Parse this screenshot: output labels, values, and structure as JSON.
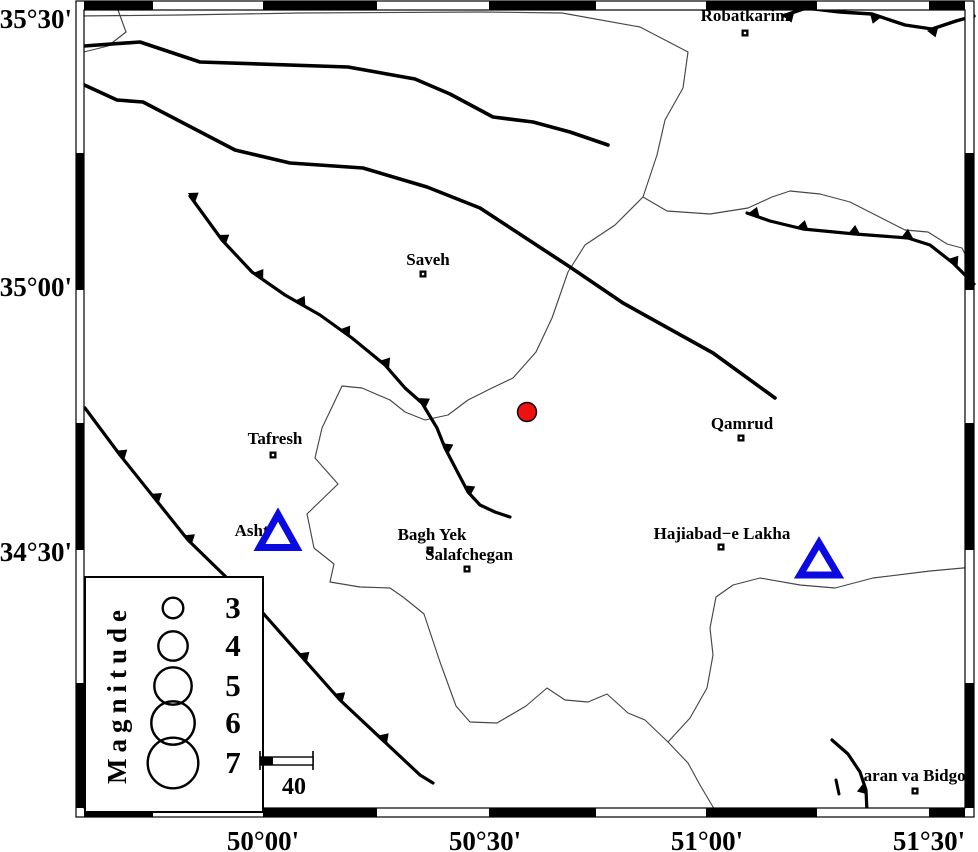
{
  "figure": {
    "kind": "seismicity-map",
    "width": 978,
    "height": 852
  },
  "colors": {
    "background": "#ffffff",
    "frame": "#000000",
    "fault": "#000000",
    "river": "#474747",
    "epicenter_fill": "#ee1111",
    "epicenter_stroke": "#000000",
    "station_stroke": "#0b0be1",
    "text": "#000000"
  },
  "axis": {
    "left_labels": [
      {
        "text": "35°30'",
        "x": 72,
        "y": 28
      },
      {
        "text": "35°00'",
        "x": 72,
        "y": 296
      },
      {
        "text": "34°30'",
        "x": 72,
        "y": 561
      }
    ],
    "bottom_labels": [
      {
        "text": "50°00'",
        "x": 263,
        "y": 850
      },
      {
        "text": "50°30'",
        "x": 485,
        "y": 850
      },
      {
        "text": "51°00'",
        "x": 707,
        "y": 850
      },
      {
        "text": "51°30'",
        "x": 929,
        "y": 850
      }
    ]
  },
  "frame": {
    "outer": [
      76,
      1,
      974,
      817
    ],
    "inner": [
      84,
      10,
      965,
      808
    ],
    "h_bounds": [
      84,
      153,
      263,
      377,
      489,
      596,
      706,
      817,
      929,
      965
    ],
    "h_first_black": true,
    "v_bounds": [
      10,
      153,
      290,
      423,
      550,
      683,
      808
    ],
    "v_first_black": false
  },
  "cities": [
    {
      "name": "Robatkarim",
      "label_x": 745,
      "label_y": 21,
      "x": 745,
      "y": 33
    },
    {
      "name": "Saveh",
      "label_x": 428,
      "label_y": 265,
      "x": 423,
      "y": 274
    },
    {
      "name": "Tafresh",
      "label_x": 275,
      "label_y": 444,
      "x": 273,
      "y": 455
    },
    {
      "name": "Ashtian",
      "label_x": 263,
      "label_y": 536,
      "x": 266,
      "y": 544
    },
    {
      "name": "Bagh Yek",
      "label_x": 432,
      "label_y": 540,
      "x": 430,
      "y": 550
    },
    {
      "name": "Salafchegan",
      "label_x": 469,
      "label_y": 560,
      "x": 467,
      "y": 569
    },
    {
      "name": "Qamrud",
      "label_x": 742,
      "label_y": 429,
      "x": 741,
      "y": 438
    },
    {
      "name": "Hajiabad−e Lakha",
      "label_x": 722,
      "label_y": 539,
      "x": 721,
      "y": 547
    },
    {
      "name": "aran va Bidgol",
      "label_x": 917,
      "label_y": 781,
      "x": 915,
      "y": 791
    }
  ],
  "epicenter": {
    "x": 527,
    "y": 412,
    "r": 9.5
  },
  "stations": [
    {
      "x": 278,
      "y": 531,
      "w": 37,
      "h": 33
    },
    {
      "x": 819,
      "y": 559,
      "w": 38,
      "h": 32
    }
  ],
  "faults": [
    {
      "id": "f1",
      "width": 3.6,
      "points": [
        [
          84,
          46
        ],
        [
          140,
          42
        ],
        [
          200,
          62
        ],
        [
          348,
          67
        ],
        [
          415,
          79
        ],
        [
          450,
          94
        ],
        [
          493,
          117
        ],
        [
          533,
          122
        ],
        [
          570,
          132
        ],
        [
          608,
          145
        ]
      ],
      "teeth": null
    },
    {
      "id": "f2",
      "width": 3.6,
      "points": [
        [
          80,
          83
        ],
        [
          117,
          100
        ],
        [
          143,
          102
        ],
        [
          235,
          150
        ],
        [
          290,
          163
        ],
        [
          363,
          168
        ],
        [
          427,
          187
        ],
        [
          480,
          208
        ],
        [
          570,
          267
        ],
        [
          623,
          303
        ],
        [
          713,
          353
        ],
        [
          775,
          398
        ]
      ],
      "teeth": null
    },
    {
      "id": "f3",
      "width": 3.2,
      "points": [
        [
          190,
          196
        ],
        [
          222,
          240
        ],
        [
          252,
          272
        ],
        [
          285,
          295
        ],
        [
          320,
          315
        ],
        [
          352,
          338
        ],
        [
          385,
          365
        ],
        [
          405,
          388
        ],
        [
          422,
          403
        ],
        [
          437,
          428
        ],
        [
          445,
          448
        ],
        [
          458,
          473
        ],
        [
          468,
          492
        ],
        [
          480,
          505
        ],
        [
          495,
          512
        ],
        [
          510,
          517
        ]
      ],
      "teeth": {
        "side": 1,
        "t": [
          0.005,
          0.117,
          0.228,
          0.336,
          0.451,
          0.56,
          0.677,
          0.787,
          0.889
        ]
      }
    },
    {
      "id": "f4",
      "width": 3.2,
      "points": [
        [
          747,
          213
        ],
        [
          770,
          221
        ],
        [
          803,
          229
        ],
        [
          855,
          234
        ],
        [
          908,
          238
        ],
        [
          930,
          245
        ],
        [
          953,
          263
        ],
        [
          974,
          284
        ]
      ],
      "teeth": {
        "side": 1,
        "t": [
          0.03,
          0.236,
          0.447,
          0.663,
          0.878
        ]
      }
    },
    {
      "id": "f5",
      "width": 3.2,
      "points": [
        [
          85,
          408
        ],
        [
          120,
          455
        ],
        [
          188,
          540
        ],
        [
          262,
          612
        ],
        [
          340,
          700
        ],
        [
          420,
          775
        ],
        [
          433,
          783
        ]
      ],
      "teeth": {
        "side": 1,
        "t": [
          0.115,
          0.223,
          0.326,
          0.647,
          0.752,
          0.87
        ]
      }
    },
    {
      "id": "f6",
      "width": 3.4,
      "points": [
        [
          783,
          16
        ],
        [
          806,
          8
        ],
        [
          840,
          12
        ],
        [
          872,
          14
        ],
        [
          905,
          25
        ],
        [
          932,
          29
        ],
        [
          956,
          21
        ],
        [
          974,
          16
        ]
      ],
      "teeth": {
        "side": -1,
        "t": [
          0.03,
          0.48,
          0.78
        ]
      }
    },
    {
      "id": "f7",
      "width": 3.2,
      "points": [
        [
          832,
          740
        ],
        [
          848,
          754
        ],
        [
          860,
          772
        ],
        [
          866,
          790
        ],
        [
          867,
          812
        ]
      ],
      "teeth": {
        "side": -1,
        "t": [
          0.72
        ]
      }
    },
    {
      "id": "f8",
      "width": 3.0,
      "points": [
        [
          836,
          780
        ],
        [
          839,
          794
        ]
      ],
      "teeth": null
    }
  ],
  "rivers": [
    {
      "id": "r-top",
      "points": [
        [
          77,
          16
        ],
        [
          180,
          15
        ],
        [
          300,
          13
        ],
        [
          480,
          12
        ],
        [
          562,
          13
        ],
        [
          640,
          27
        ],
        [
          688,
          52
        ],
        [
          683,
          88
        ],
        [
          665,
          120
        ],
        [
          657,
          155
        ],
        [
          643,
          197
        ]
      ]
    },
    {
      "id": "r-top-stub",
      "points": [
        [
          118,
          10
        ],
        [
          126,
          32
        ],
        [
          108,
          46
        ],
        [
          84,
          52
        ]
      ]
    },
    {
      "id": "r-east",
      "points": [
        [
          643,
          197
        ],
        [
          667,
          211
        ],
        [
          710,
          214
        ],
        [
          748,
          208
        ],
        [
          772,
          197
        ],
        [
          790,
          191
        ],
        [
          820,
          194
        ],
        [
          850,
          202
        ],
        [
          905,
          230
        ],
        [
          928,
          232
        ],
        [
          947,
          244
        ],
        [
          962,
          248
        ],
        [
          970,
          264
        ],
        [
          974,
          292
        ]
      ]
    },
    {
      "id": "r-boundary",
      "points": [
        [
          643,
          197
        ],
        [
          615,
          225
        ],
        [
          585,
          245
        ],
        [
          568,
          272
        ],
        [
          552,
          318
        ],
        [
          536,
          352
        ],
        [
          513,
          378
        ],
        [
          492,
          388
        ],
        [
          468,
          400
        ],
        [
          448,
          415
        ],
        [
          425,
          420
        ],
        [
          405,
          412
        ],
        [
          390,
          400
        ],
        [
          362,
          388
        ],
        [
          342,
          386
        ],
        [
          322,
          428
        ],
        [
          315,
          458
        ],
        [
          338,
          484
        ],
        [
          307,
          514
        ],
        [
          314,
          548
        ],
        [
          334,
          564
        ],
        [
          330,
          582
        ],
        [
          360,
          587
        ],
        [
          390,
          588
        ],
        [
          403,
          597
        ],
        [
          413,
          605
        ],
        [
          424,
          614
        ],
        [
          440,
          662
        ],
        [
          456,
          706
        ],
        [
          470,
          722
        ],
        [
          497,
          723
        ],
        [
          526,
          706
        ],
        [
          547,
          688
        ],
        [
          565,
          700
        ],
        [
          588,
          702
        ],
        [
          607,
          694
        ],
        [
          628,
          713
        ],
        [
          645,
          720
        ],
        [
          668,
          742
        ],
        [
          688,
          763
        ],
        [
          700,
          785
        ],
        [
          716,
          812
        ]
      ]
    },
    {
      "id": "r-southeast",
      "points": [
        [
          668,
          742
        ],
        [
          690,
          718
        ],
        [
          707,
          688
        ],
        [
          713,
          655
        ],
        [
          710,
          628
        ],
        [
          716,
          597
        ],
        [
          733,
          585
        ],
        [
          760,
          578
        ],
        [
          800,
          585
        ],
        [
          835,
          588
        ],
        [
          873,
          578
        ],
        [
          930,
          571
        ],
        [
          974,
          567
        ]
      ]
    }
  ],
  "legend": {
    "box": {
      "x": 85,
      "y": 577,
      "w": 178,
      "h": 235
    },
    "title": "Magnitude",
    "title_x": 126,
    "title_y": 694,
    "circle_cx": 173,
    "num_x": 233,
    "entries": [
      {
        "mag": "3",
        "r": 10.3,
        "cy": 608
      },
      {
        "mag": "4",
        "r": 14.7,
        "cy": 646
      },
      {
        "mag": "5",
        "r": 18.7,
        "cy": 686
      },
      {
        "mag": "6",
        "r": 21.7,
        "cy": 723
      },
      {
        "mag": "7",
        "r": 25.3,
        "cy": 763
      }
    ]
  },
  "scalebar": {
    "label": "40",
    "x1": 260,
    "x2": 313,
    "bar_y": 757,
    "bar_h": 8,
    "black_w": 13,
    "tick_y1": 751,
    "tick_y2": 770,
    "label_x": 294,
    "label_y": 794
  }
}
